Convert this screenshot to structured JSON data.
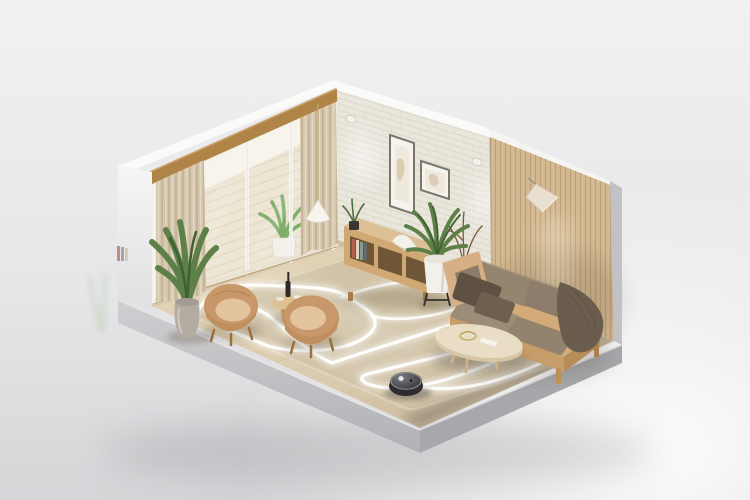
{
  "meta": {
    "title": "Isometric cutaway living room with a robot vacuum tracing a glowing serpentine cleaning path",
    "description": "3D diorama of a living room: sliding glass doors with curtains on the left wall, white brick back wall with framed art, wooden slat right wall with a cone lamp, wooden sideboard with plants, fabric sofa with wood frame, round coffee table, two camel barrel armchairs with a side table, large potted plants, beige rug on wood floor, and a dark round robot vacuum whose cleaning route is drawn as a glowing white looped line."
  },
  "palette": {
    "bg-top": "#f1f1f2",
    "bg-bottom": "#d6d6d9",
    "wall-cap": "#fafaf9",
    "wall-outer": "#ededef",
    "brick": "#efece3",
    "brick-line": "#e1ddd1",
    "slat": "#d8c09b",
    "slat-line": "#c2a77e",
    "beam": "#b08347",
    "curtain": "#d5c7ae",
    "curtain-line": "#c3b294",
    "glass-out": "#f7f4ec",
    "deck": "#eee6d4",
    "deck-line": "#ded2ba",
    "floor-wood": "#dbcbae",
    "plank-line": "#c9b894",
    "rug": "#d2c4a8",
    "rug-edge": "#e6dcc6",
    "path-glow": "#ffffff",
    "slab-light": "#cdcdd0",
    "slab-dark": "#a8a8ac",
    "sofa-frame": "#d2ab79",
    "sofa-fabric": "#94846f",
    "pillow-dark": "#5e5143",
    "throw": "#6b5d4d",
    "armchair": "#c9986a",
    "armchair-seat": "#e4c49e",
    "table-top": "#e9ddc5",
    "console-front": "#cfa873",
    "console-top": "#dcbf94",
    "console-side": "#b98f5c",
    "plant-green": "#5d8048",
    "plant-dark": "#3e6032",
    "pot-white": "#f2f0ea",
    "pot-gray": "#b2aca2",
    "vase-sand": "#cbb89a",
    "robot-body": "#2d2d31",
    "robot-top": "#55555c",
    "lamp-shade": "#e9dfd0"
  },
  "cleaning_path": {
    "main": "M197,312 C205,296 228,284 258,285 C295,287 331,286 346,296 C361,306 373,311 375,321 C377,334 357,344 337,348 C309,353 277,351 261,343 C245,336 221,330 223,320 C224,311 236,305 248,307 C263,309 273,319 283,328 C300,343 314,355 332,363 C372,349 431,332 469,319 C487,313 503,319 498,331 C495,340 471,348 449,354 C421,361 391,368 368,374 C357,377 361,383 375,386 C387,389 399,389 413,387 C451,381 501,362 528,343 C544,332 563,341 556,353 C545,363 516,375 486,383 C461,389 435,391 411,385",
    "secondary": "M342,297 C380,283 421,276 454,286 C470,291 472,301 460,307 C432,318 397,322 371,316"
  },
  "objects": {
    "room": "living room cutaway",
    "robot": "robot vacuum",
    "path": "vacuum cleaning route",
    "rug": "beige area rug",
    "sofa": "wood-frame fabric sofa",
    "coffee_table": "round coffee table",
    "armchair1": "camel barrel armchair",
    "armchair2": "camel barrel armchair",
    "side_table": "round side table with bottle",
    "floor_plant": "large potted plant",
    "palm_plant": "potted palm",
    "branch_vase": "vase with branches",
    "console": "wooden sideboard with books",
    "art": "framed wall art",
    "slat_lamp": "cone wall lamp",
    "pendant": "pendant lamp",
    "doors": "sliding glass doors to balcony",
    "curtains": "beige curtains",
    "brick_wall": "white brick wall",
    "slat_wall": "wood slat wall",
    "balcony_plant": "balcony plant"
  }
}
